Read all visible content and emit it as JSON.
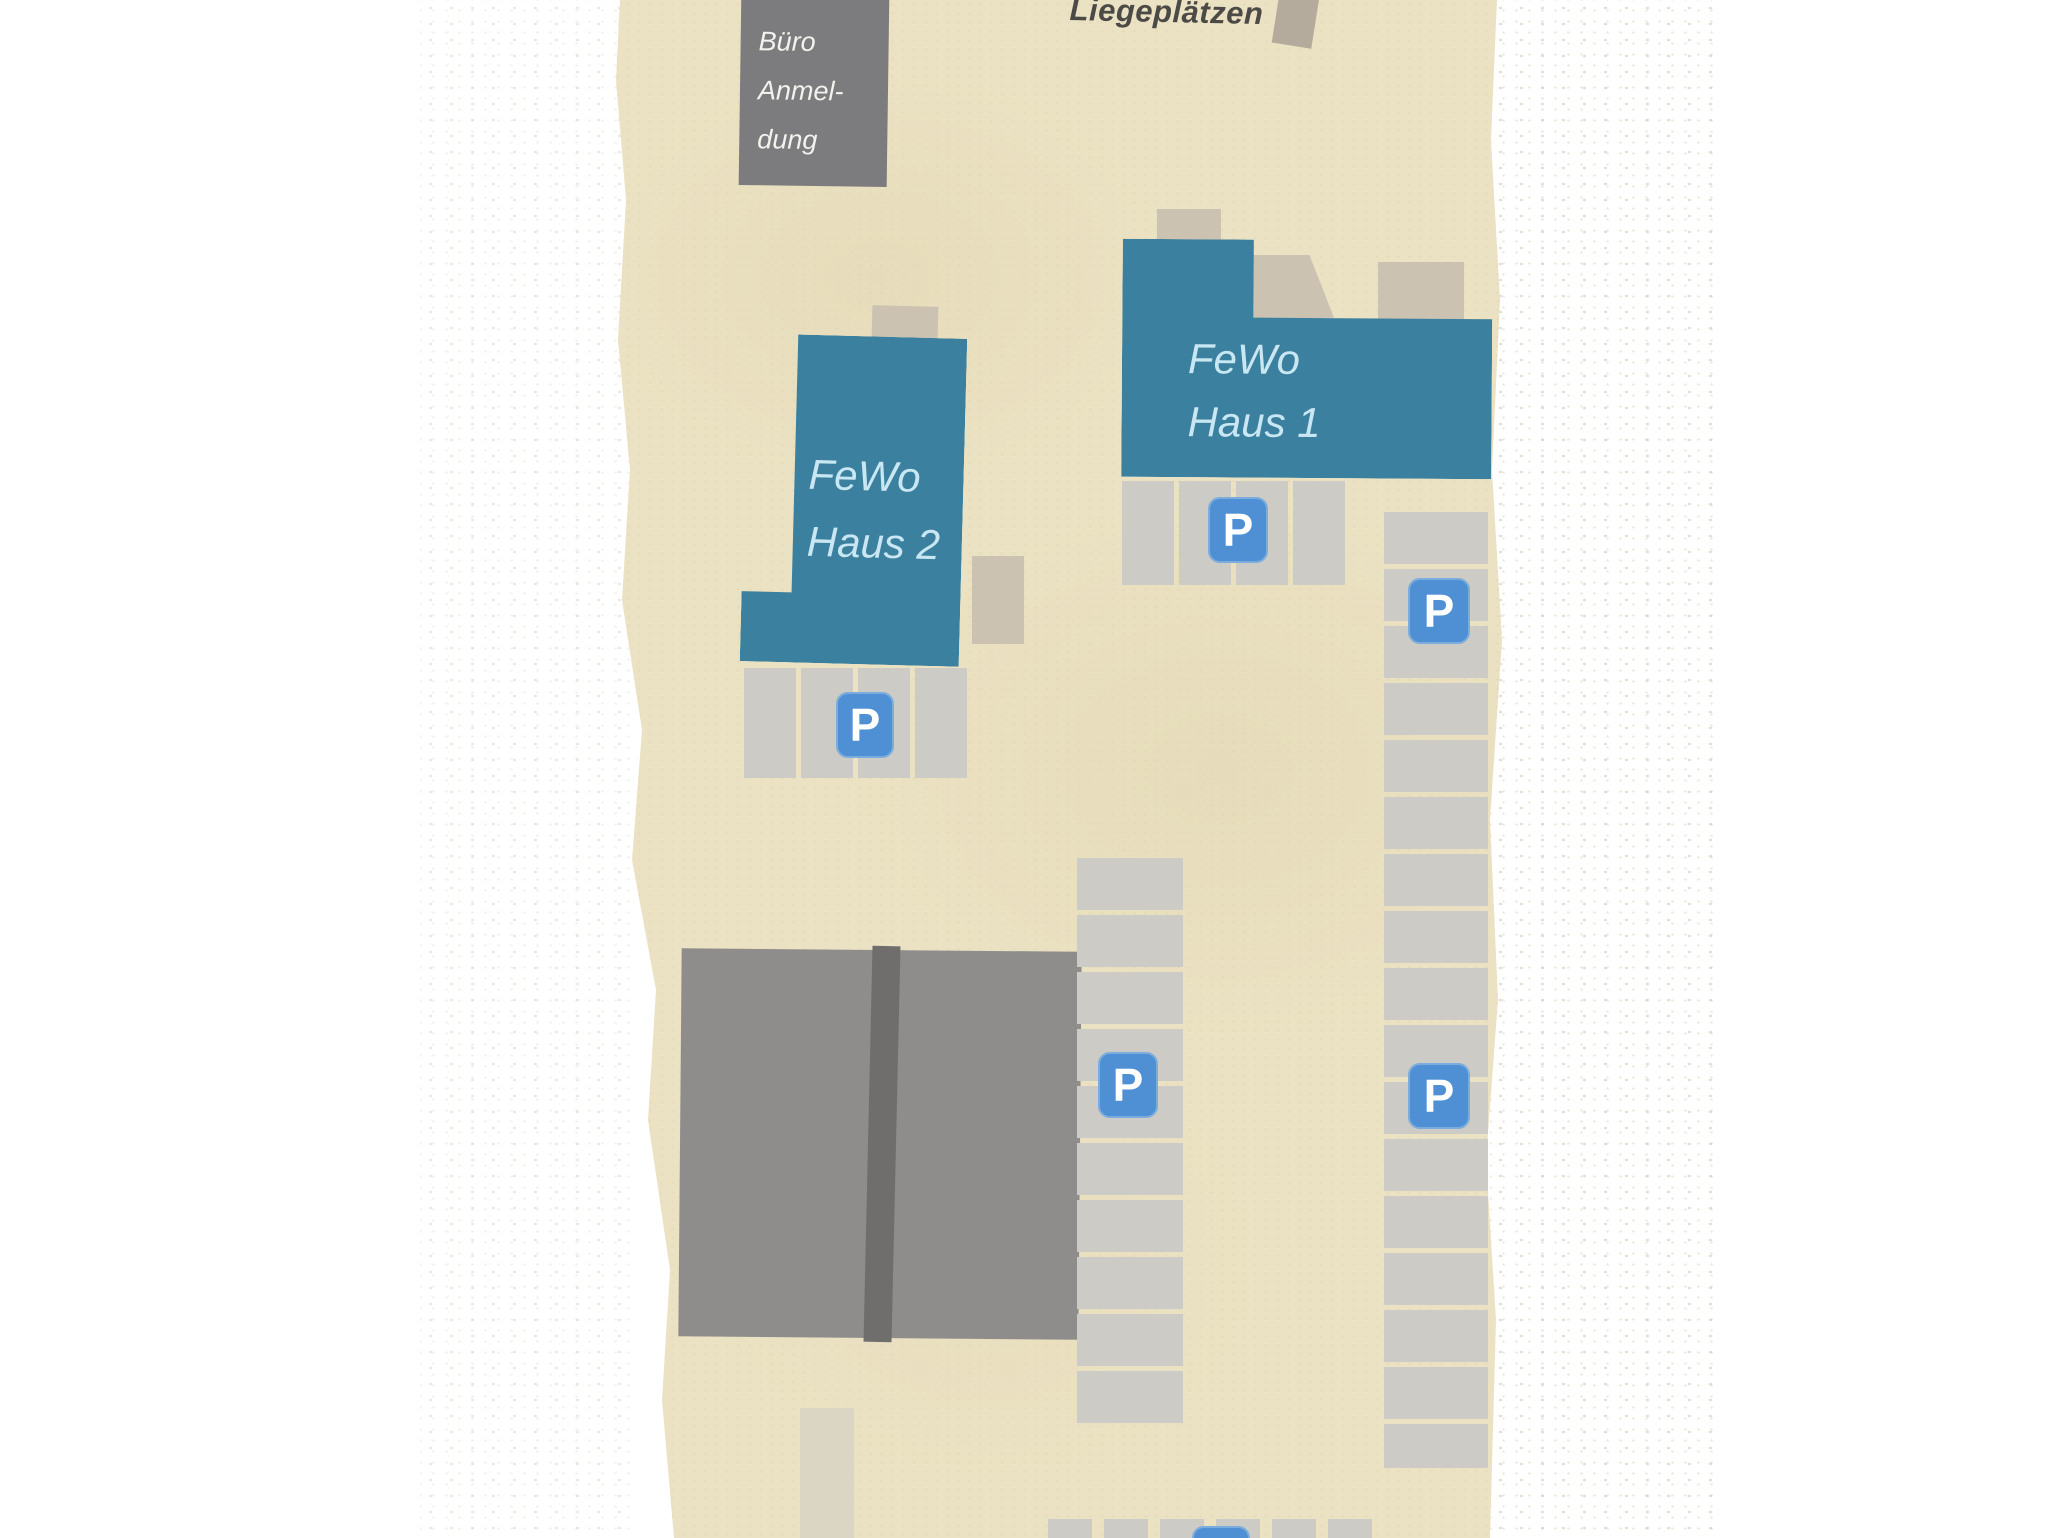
{
  "map": {
    "labels": {
      "office": {
        "line1": "Büro",
        "line2": "Anmel-",
        "line3": "dung"
      },
      "berths": "Liegeplätzen",
      "house1": {
        "line1": "FeWo",
        "line2": "Haus 1"
      },
      "house2": {
        "line1": "FeWo",
        "line2": "Haus 2"
      }
    },
    "parking_sign_letter": "P",
    "colors": {
      "map_beige": "#ebe2c3",
      "building_teal": "#3b809e",
      "building_gray_dark": "#7c7b7d",
      "building_gray_large": "#8e8d8b",
      "building_gray_stripe": "#6f6e6c",
      "accent_tan": "#cbc2b2",
      "pier_tan": "#b4ab9c",
      "parking_stall": "#cdcbc5",
      "parking_sign_blue": "#4e90d3",
      "road_gray": "#d5d2c4",
      "label_light": "#c9e7f3",
      "label_dark": "#4b4a47"
    }
  }
}
